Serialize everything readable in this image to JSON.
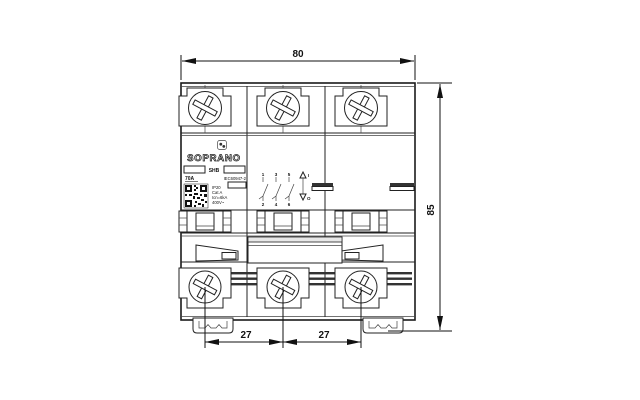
{
  "drawing": {
    "title": "3-pole miniature circuit breaker - front view dimensional drawing",
    "dimensions": {
      "width": "80",
      "height": "85",
      "pitches": [
        "27",
        "27"
      ]
    },
    "nameplate": {
      "brand": "SOPRANO",
      "model": "SHB",
      "current_rating": "70A",
      "standard": "IEC60947-2",
      "specs": [
        "IP20",
        "Cat A",
        "Icn=6kA",
        "400V~"
      ]
    },
    "schematic": {
      "top_terminals": [
        "1",
        "3",
        "5"
      ],
      "bottom_terminals": [
        "2",
        "4",
        "6"
      ],
      "on_label": "I",
      "off_label": "O"
    },
    "colors": {
      "line": "#222222",
      "background": "#ffffff"
    }
  }
}
